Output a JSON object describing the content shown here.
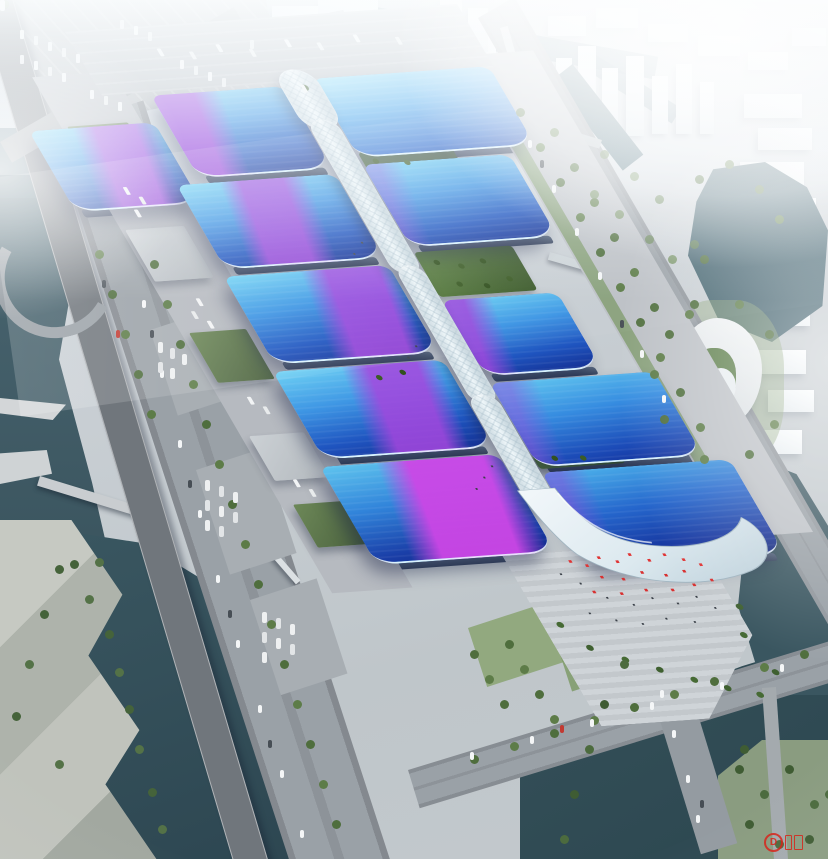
{
  "scene": {
    "description": "Hazy aerial rendering of a mega exhibition & convention center: two columns of wavy blue-roofed halls with sweeping purple ribbon bands flank a sinuous white central spine gallery, ending in a wave-shaped south lobby and entrance plaza with red flags and palms; the site is ringed by boulevards, service yards, rivers with bridges, a spiral white cultural building, waterfront parks and a fog-covered city skyline.",
    "features": [
      "exhibition-halls",
      "central-spine-gallery",
      "south-entrance-plaza",
      "service-yards",
      "truck-parking",
      "bus-parking",
      "west-boulevard",
      "elevated-expressway",
      "east-road",
      "river-bridges",
      "spiral-building",
      "waterfront-park",
      "city-skyline-in-fog"
    ]
  },
  "watermark": {
    "label": "D",
    "color": "#d8261c"
  },
  "palette": {
    "roof_cyan": "#6fd2f4",
    "roof_blue": "#3e96e4",
    "roof_deep": "#16349f",
    "ribbon_purple": "#a84ae0",
    "ribbon_magenta": "#cd46e6",
    "spine_white": "#eef6f9",
    "water_dark": "#2e4953",
    "greenery": "#4f6e3d",
    "road_gray": "#9aa1a7",
    "flag_red": "#e03434"
  }
}
